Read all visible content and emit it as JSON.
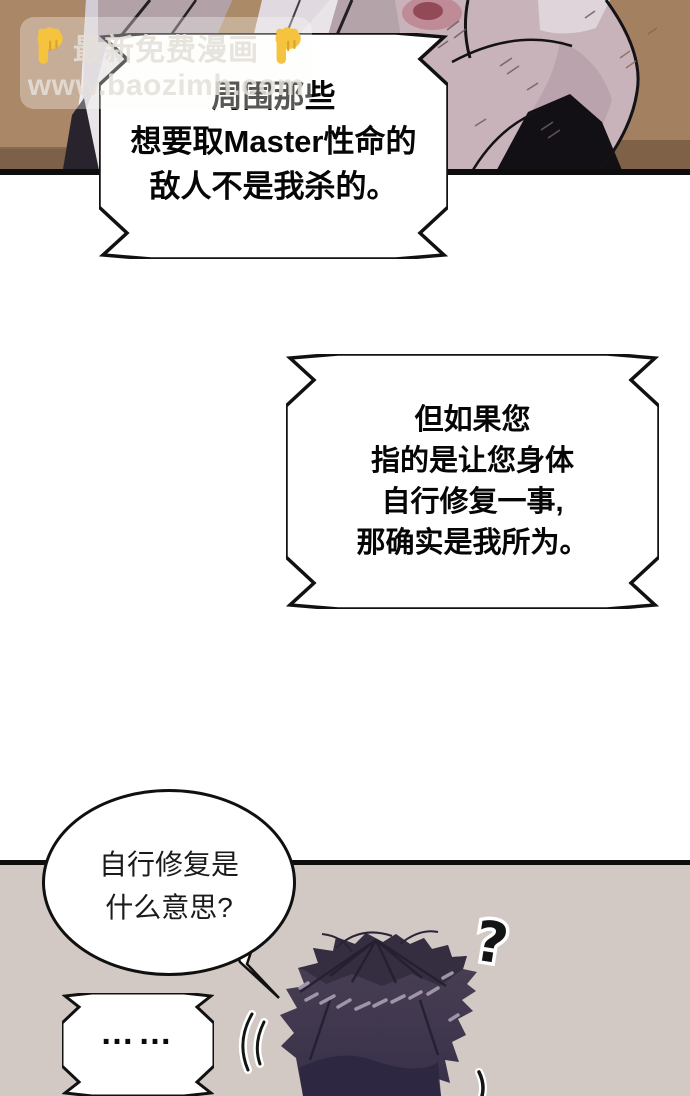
{
  "watermark": {
    "icon_left": "pointing-down-hand-emoji",
    "icon_right": "pointing-down-hand-emoji",
    "banner_text": "最新免费漫画",
    "site_url": "www.baozimh.com"
  },
  "speech_bubbles": {
    "bubble1": {
      "style": "jagged-rect",
      "lines": [
        "周围那些",
        "想要取Master性命的",
        "敌人不是我杀的。"
      ]
    },
    "bubble2": {
      "style": "jagged-rect",
      "lines": [
        "但如果您",
        "指的是让您身体",
        "自行修复一事,",
        "那确实是我所为。"
      ]
    },
    "bubble3": {
      "style": "round-ellipse",
      "lines": [
        "自行修复是",
        "什么意思?"
      ]
    },
    "bubble4": {
      "style": "jagged-rect-small",
      "text": "……"
    }
  },
  "sfx": {
    "question_mark": "?"
  },
  "colors": {
    "top_panel_background_brown": "#aa8767",
    "top_panel_table_brown": "#7c6049",
    "lower_panel_background": "#d2c9c5",
    "gutter_white": "#ffffff",
    "bubble_fill": "#ffffff",
    "bubble_border": "#111111",
    "robe_white": "#e9e4e8",
    "robe_mauve": "#b2a2a8",
    "robe_pink": "#c8b3bb",
    "wound_red": "#8e4350",
    "hair_base": "#463d51",
    "hair_dark": "#332c3e",
    "hair_highlight": "#a094aa",
    "watermark_hand_yellow": "#f5c33e"
  }
}
